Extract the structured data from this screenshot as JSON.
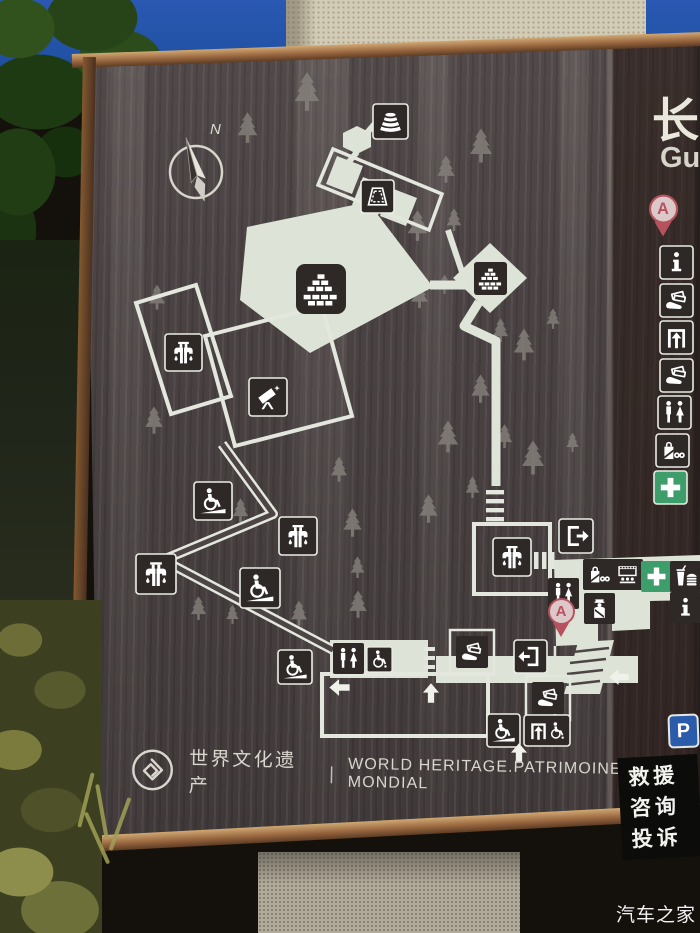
{
  "photo": {
    "watermark": "汽车之家"
  },
  "board": {
    "compass_label": "N",
    "side_panel": {
      "title_cn": "长",
      "title_en": "Gu"
    },
    "heritage": {
      "text_cn": "世界文化遗产",
      "divider": "|",
      "text_en": "WORLD HERITAGE.PATRIMOINE MONDIAL"
    },
    "marker_label": "A",
    "parking_label": "P",
    "rescue_panel": {
      "line1": "救援",
      "line2": "咨询",
      "line3": "投诉"
    },
    "legend_icons": [
      "location-marker-a",
      "information",
      "tickets",
      "entrance-gate",
      "tickets",
      "toilets",
      "shop",
      "first-aid"
    ],
    "map_facilities": [
      "beacon-tower",
      "stage",
      "great-wall-relic",
      "water-tap",
      "viewing-telescope",
      "accessible-ramp",
      "wheelchair-access",
      "toilets",
      "accessible-toilet",
      "tickets",
      "exit-door",
      "entry-door",
      "entrance-gate",
      "shop",
      "cinema",
      "security-post",
      "first-aid",
      "food-court",
      "information",
      "parking",
      "stairs"
    ],
    "colors": {
      "board_bg": "#4c4445",
      "side_panel_dark": "#342720",
      "path_light": "#dde3d6",
      "icon_box_dark": "#2e2927",
      "first_aid_green": "#3d9e6b",
      "parking_blue": "#2b5cab",
      "marker_red": "#b5525e",
      "frame_copper": "#9c6a43",
      "sky_blue": "#2455a8"
    }
  }
}
